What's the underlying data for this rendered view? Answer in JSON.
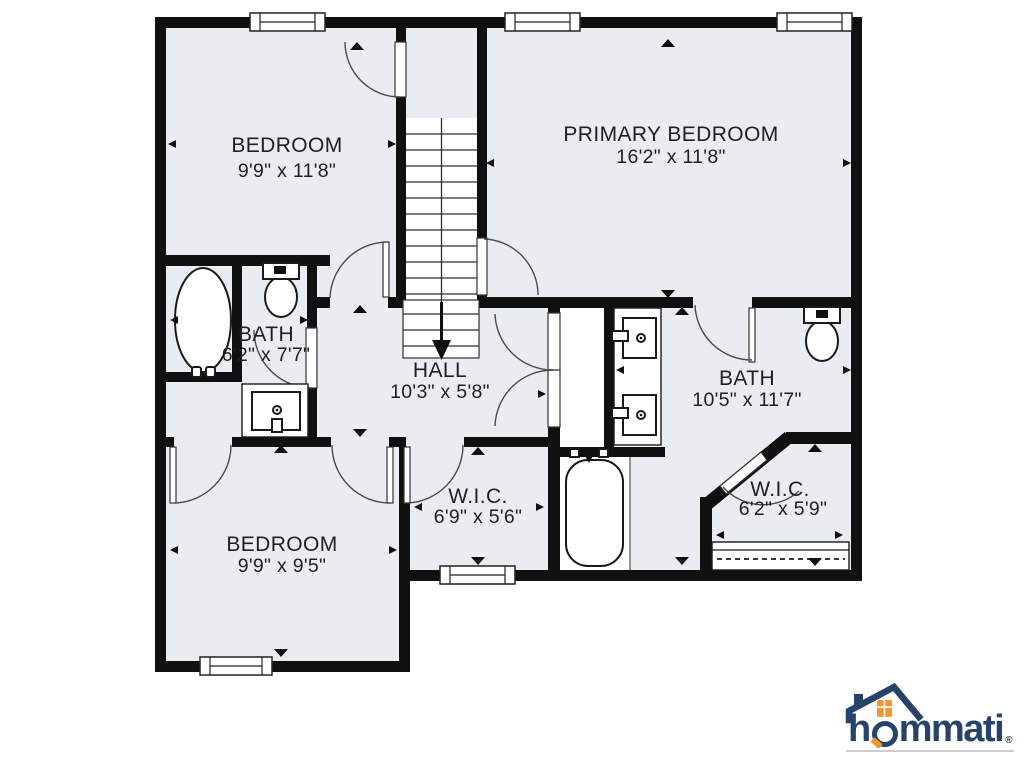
{
  "plan": {
    "rooms": [
      {
        "id": "bedroom-top-left",
        "name": "BEDROOM",
        "dims": "9'9\" x 11'8\""
      },
      {
        "id": "primary-bedroom",
        "name": "PRIMARY BEDROOM",
        "dims": "16'2\" x 11'8\""
      },
      {
        "id": "bath-left",
        "name": "BATH",
        "dims": "6'2\" x 7'7\""
      },
      {
        "id": "hall",
        "name": "HALL",
        "dims": "10'3\" x 5'8\""
      },
      {
        "id": "bath-right",
        "name": "BATH",
        "dims": "10'5\" x 11'7\""
      },
      {
        "id": "wic-middle",
        "name": "W.I.C.",
        "dims": "6'9\" x 5'6\""
      },
      {
        "id": "wic-right",
        "name": "W.I.C.",
        "dims": "6'2\" x 5'9\""
      },
      {
        "id": "bedroom-bottom-left",
        "name": "BEDROOM",
        "dims": "9'9\" x 9'5\""
      }
    ]
  },
  "logo": {
    "text_before_o": "h",
    "text_after_o": "mmati",
    "registered_mark": "®"
  },
  "colors": {
    "wall": "#101010",
    "floor": "#e9edf1",
    "fixture_stroke": "#1a1a1a",
    "label": "#1f1f1f",
    "logo_navy": "#27426b",
    "logo_orange": "#f0982e",
    "logo_underline": "#cccccc"
  }
}
